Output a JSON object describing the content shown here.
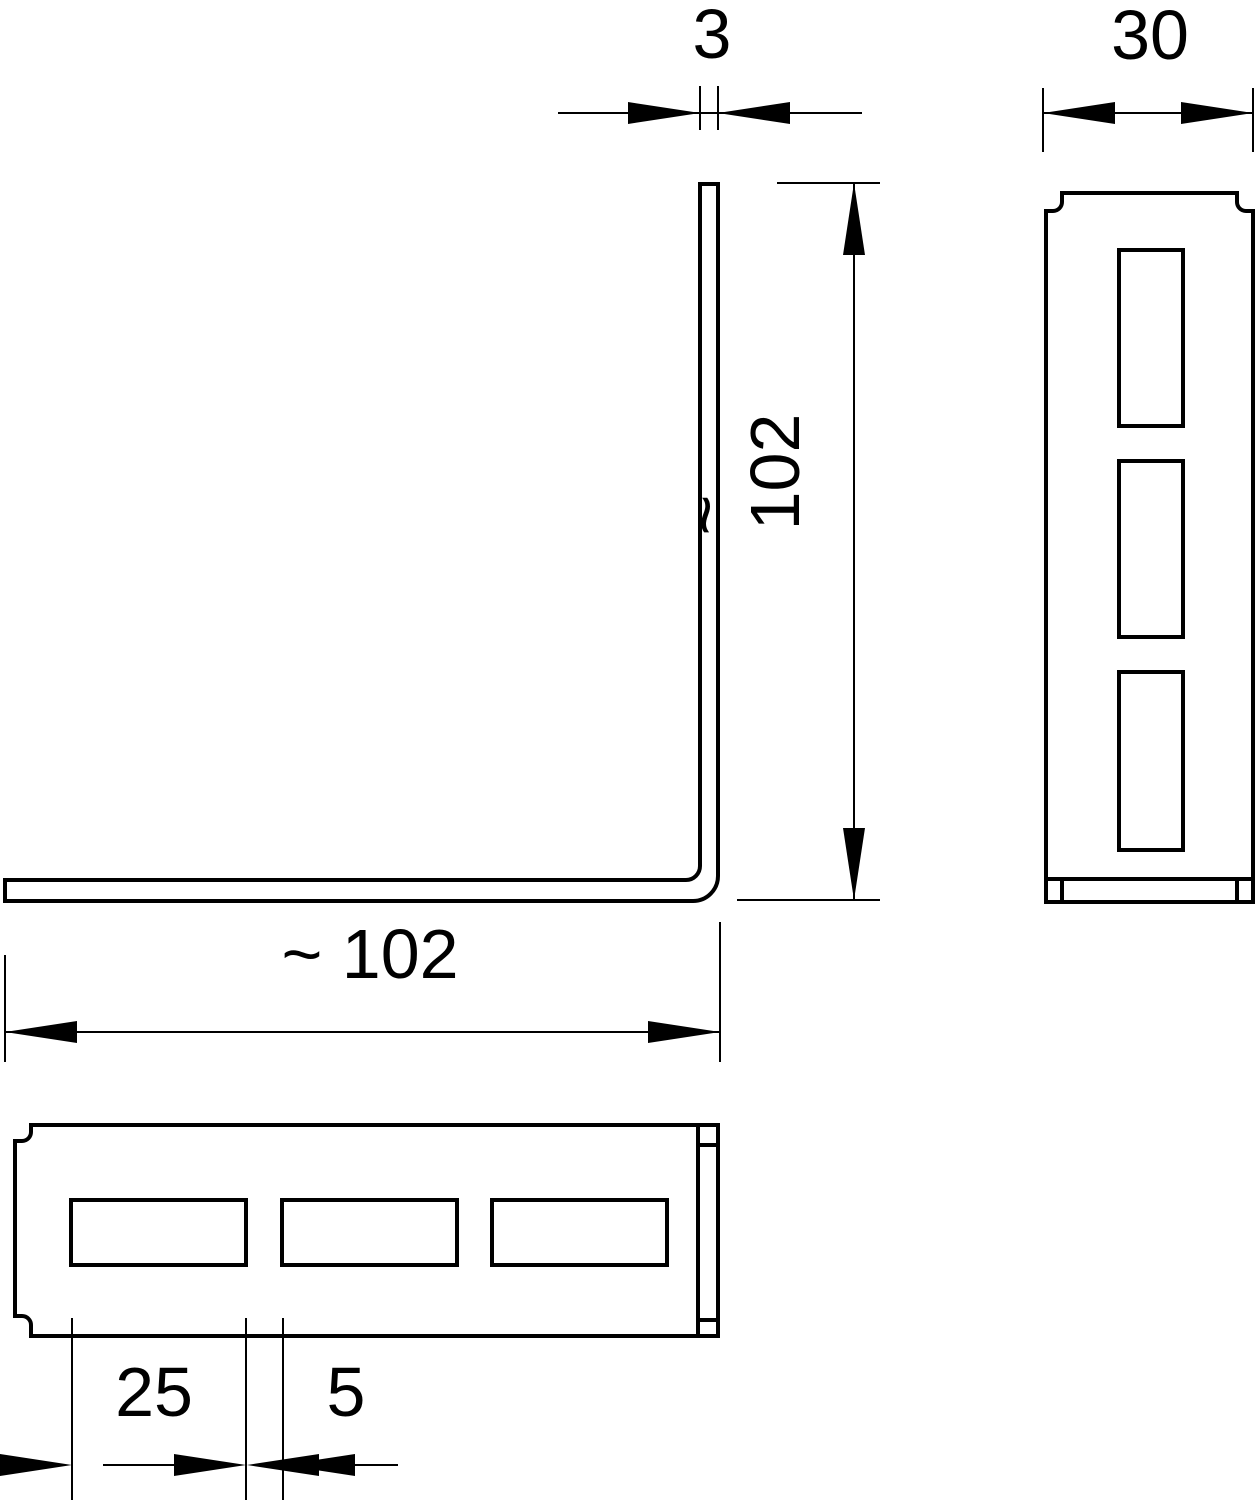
{
  "drawing": {
    "type": "technical-dimension-drawing",
    "colors": {
      "line": "#000000",
      "background": "#ffffff"
    },
    "dimensions": {
      "thickness": "3",
      "flange_width": "30",
      "height": "102",
      "height_approx_sign": "~",
      "length": "~ 102",
      "slot_length": "25",
      "slot_spacing": "5"
    }
  }
}
